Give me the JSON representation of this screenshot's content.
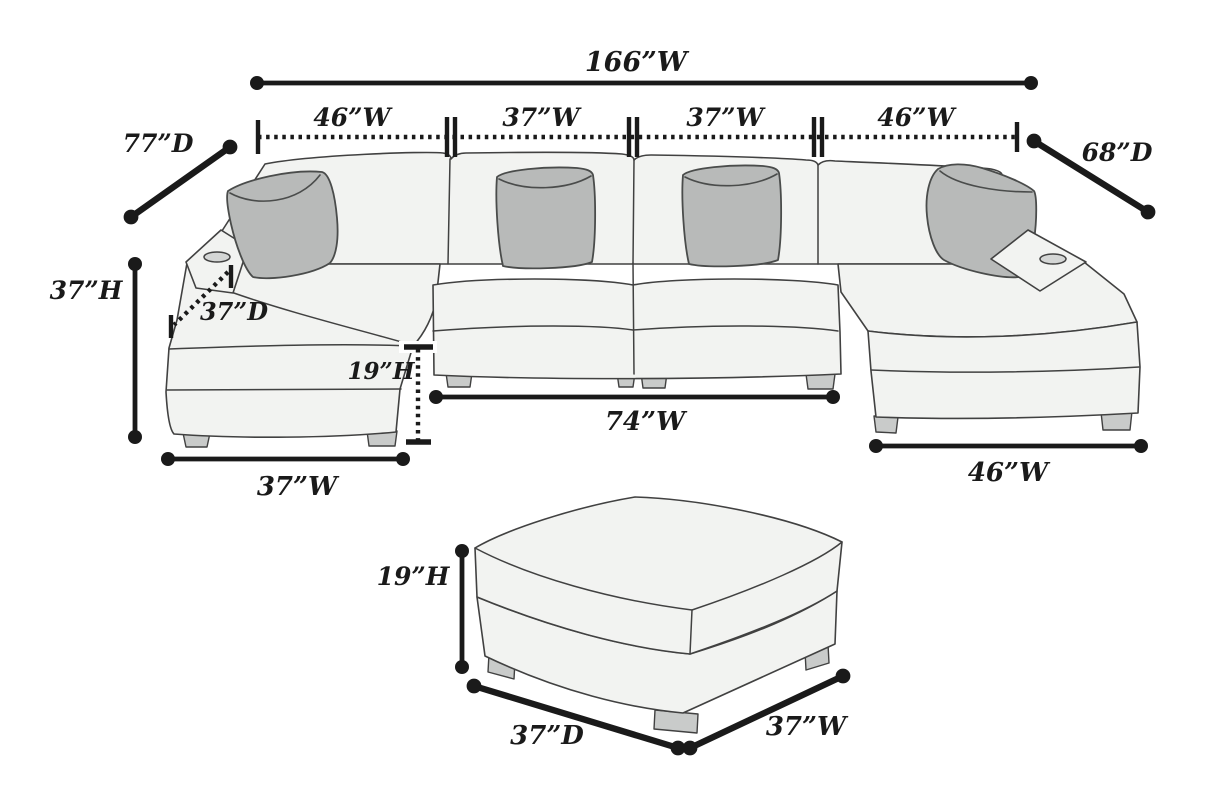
{
  "palette": {
    "dimension_color": "#1a1a1a",
    "outline_color": "#414141",
    "sofa_body_fill": "#f2f3f1",
    "pillow_fill": "#b8bab9",
    "leg_fill": "#c9cbca",
    "background": "#ffffff"
  },
  "sectional": {
    "overall_width_label": "166”W",
    "segment_labels": [
      "46”W",
      "37”W",
      "37”W",
      "46”W"
    ],
    "left_depth_label": "77”D",
    "right_depth_label": "68”D",
    "overall_height_label": "37”H",
    "chaise_depth_label": "37”D",
    "seat_height_label": "19”H",
    "center_width_label": "74”W",
    "left_chaise_width_label": "37”W",
    "right_chaise_width_label": "46”W"
  },
  "ottoman": {
    "height_label": "19”H",
    "depth_label": "37”D",
    "width_label": "37”W"
  }
}
